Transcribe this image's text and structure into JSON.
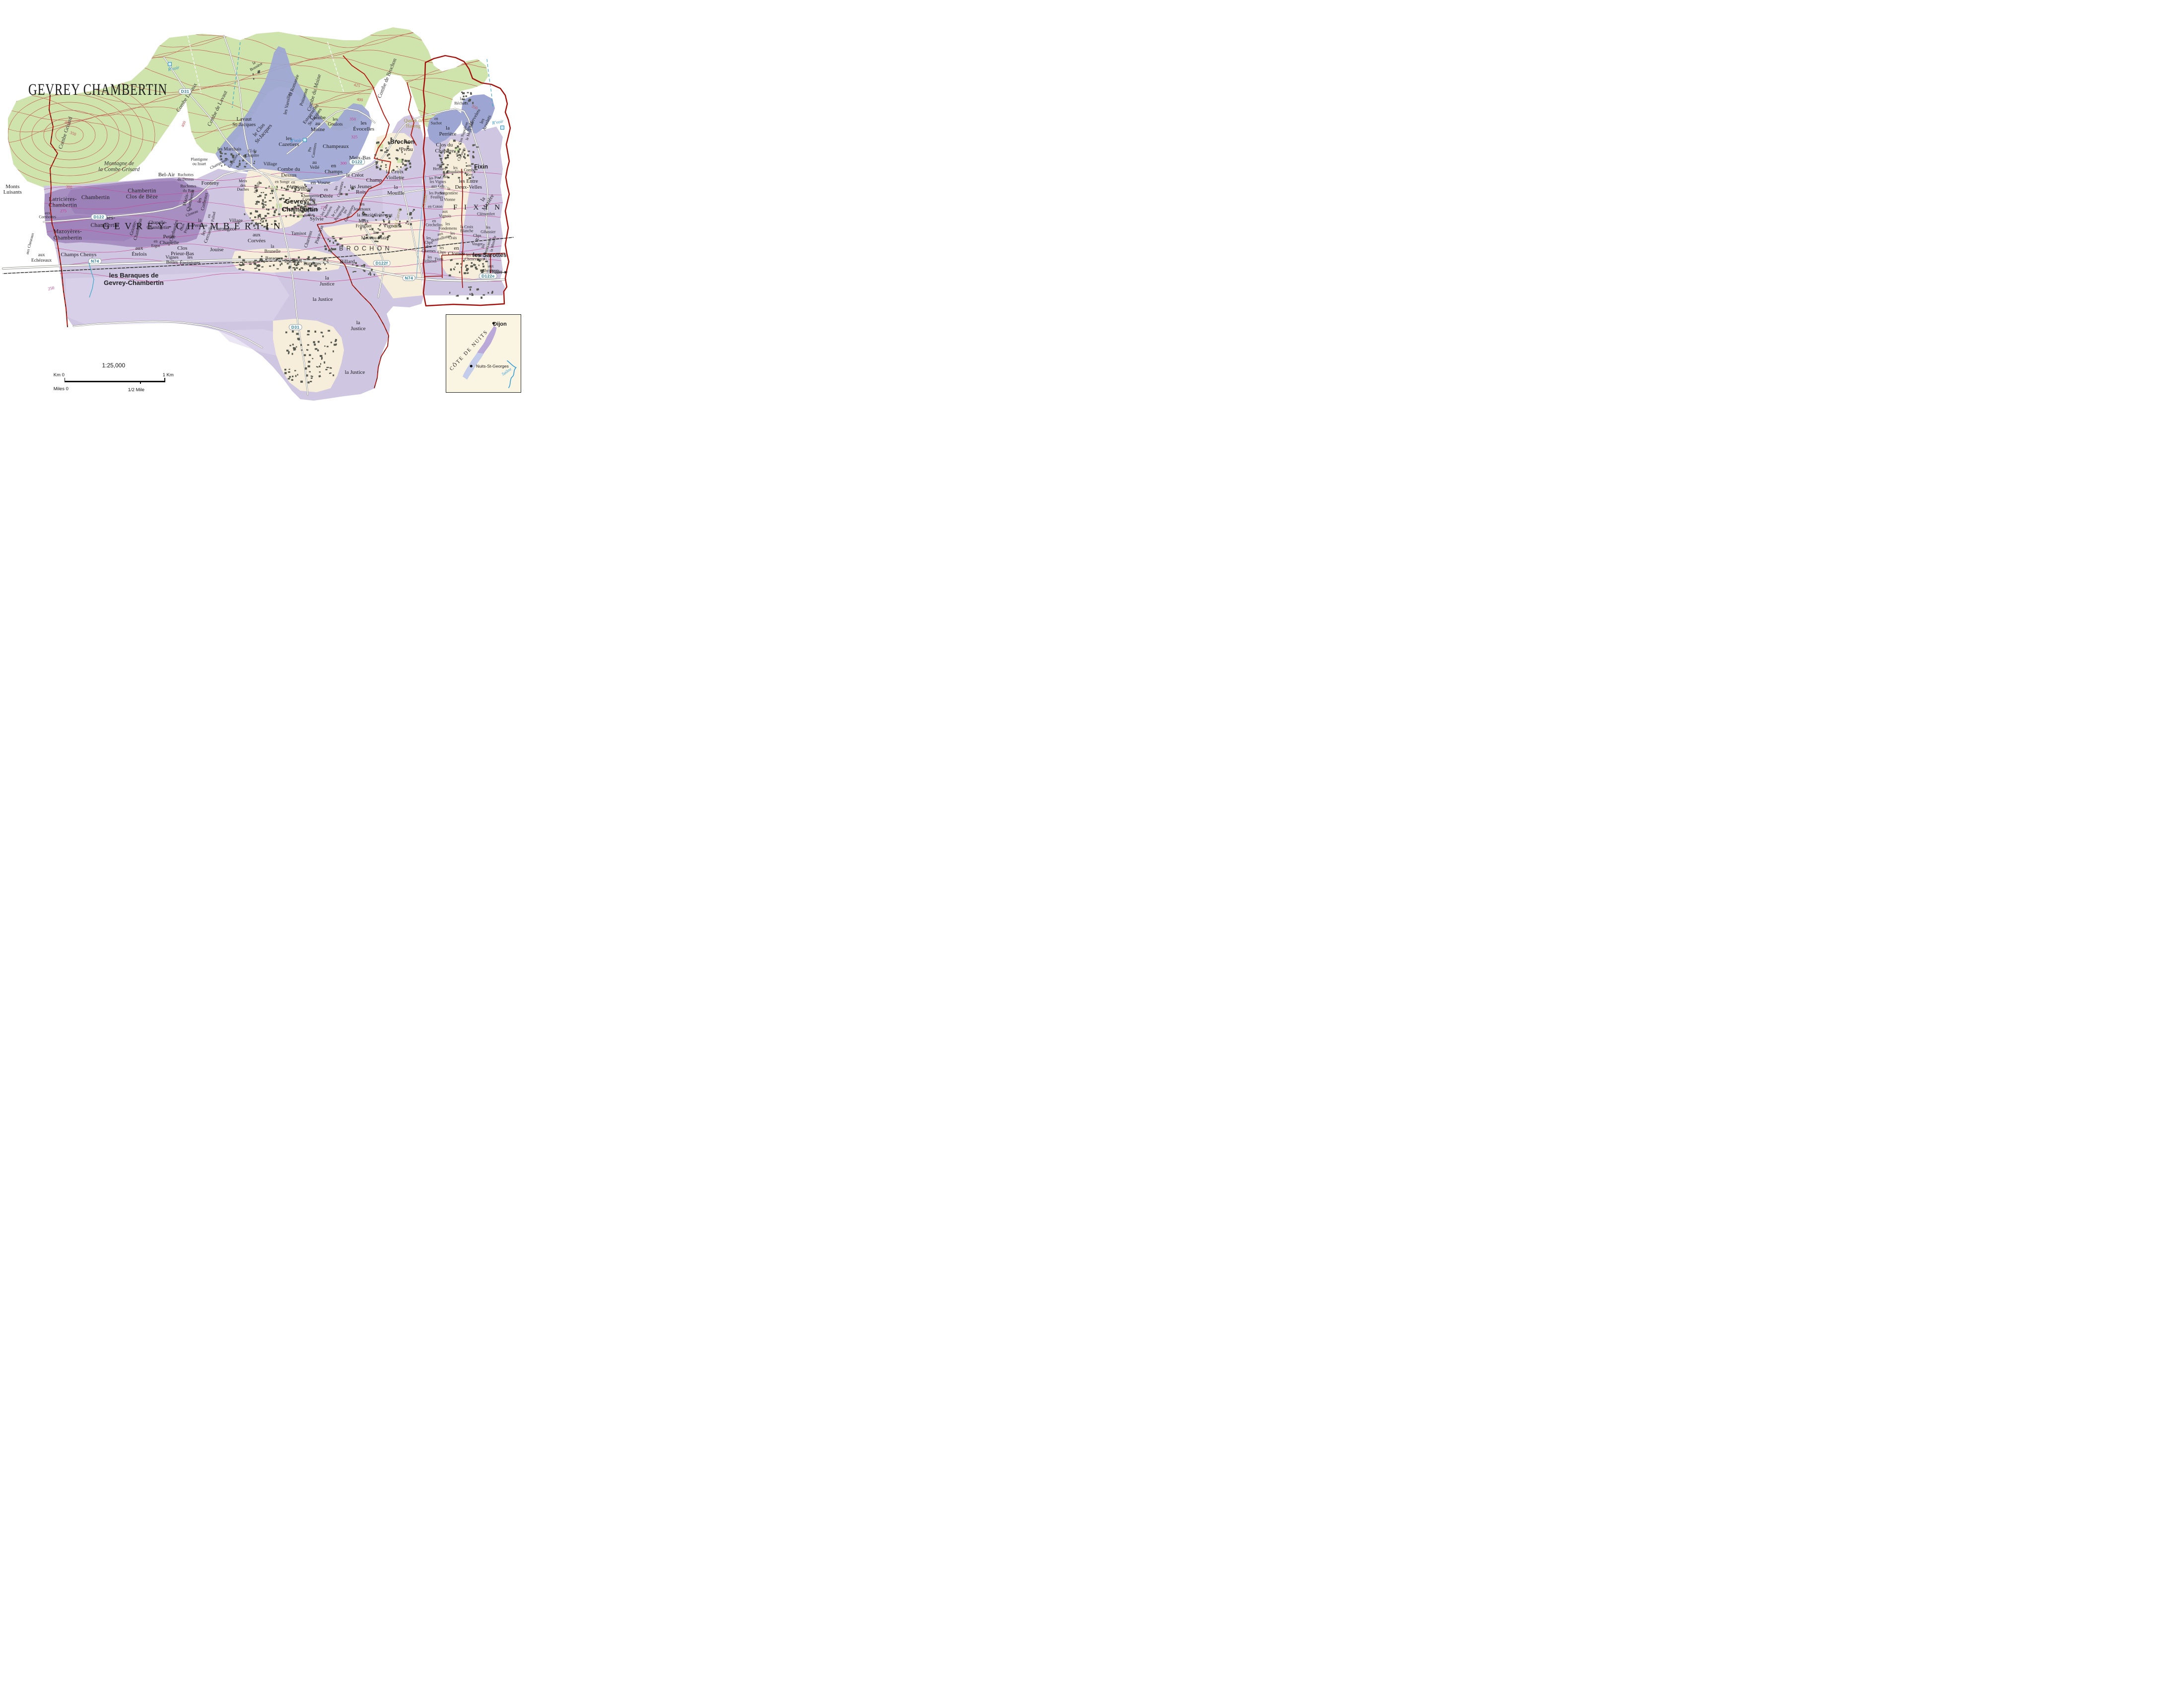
{
  "title": "GEVREY CHAMBERTIN",
  "scale_bar": {
    "ratio": "1:25,000",
    "km_zero": "Km 0",
    "km_one": "1 Km",
    "miles_zero": "Miles 0",
    "half_mile": "1/2 Mile"
  },
  "inset": {
    "region": "CÔTE DE NUITS",
    "city_north": "Dijon",
    "city_south": "Nuits-St-Georges",
    "river": "Saône"
  },
  "colors": {
    "boundary_red": "#b5170b",
    "grand_cru": "#9a7fb7",
    "premier_cru": "#9da5d3",
    "village_aoc": "#cfc6e2",
    "woodland": "#cfe3ad",
    "water_blue": "#2d93c9",
    "contour_woodland": "#c2564e",
    "contour_vineyard": "#c64a97",
    "road_badge_text": "#2e7f99",
    "building_grey": "#55594f",
    "town_cream": "#f6eeda"
  },
  "badges": [
    {
      "t": "D31",
      "x": 33.9,
      "y": 21.6
    },
    {
      "t": "D122",
      "x": 18.1,
      "y": 51.4
    },
    {
      "t": "D122",
      "x": 65.4,
      "y": 38.3
    },
    {
      "t": "N74",
      "x": 17.4,
      "y": 61.9
    },
    {
      "t": "N74",
      "x": 74.9,
      "y": 65.9
    },
    {
      "t": "D122f",
      "x": 69.9,
      "y": 62.4
    },
    {
      "t": "D122e",
      "x": 89.4,
      "y": 65.4
    },
    {
      "t": "D31",
      "x": 54.1,
      "y": 77.5
    }
  ],
  "labels": [
    {
      "t": "Combe Grisard",
      "x": 12.1,
      "y": 31.5,
      "c": "combe",
      "r": -72
    },
    {
      "t": "Montagne de\nla Combe Grisard",
      "x": 21.8,
      "y": 39.5,
      "c": "geoit"
    },
    {
      "t": "Combe Lavaux",
      "x": 34.3,
      "y": 23.2,
      "c": "combe",
      "r": -57
    },
    {
      "t": "Combe de Lavaut",
      "x": 39.9,
      "y": 25.8,
      "c": "combe",
      "r": -64
    },
    {
      "t": "la\nBossière",
      "x": 46.7,
      "y": 15.4,
      "c": "vys",
      "r": -30
    },
    {
      "t": "Combe du Moine",
      "x": 57.6,
      "y": 22.0,
      "c": "combe",
      "r": -74
    },
    {
      "t": "Combe de Brochon",
      "x": 71.0,
      "y": 18.6,
      "c": "combe",
      "r": -68
    },
    {
      "t": "Queue de\nHareng",
      "x": 75.7,
      "y": 29.4,
      "c": "olive"
    },
    {
      "t": "R'voir",
      "x": 31.8,
      "y": 16.3,
      "c": "water",
      "r": -12
    },
    {
      "t": "R'voir",
      "x": 54.2,
      "y": 33.4,
      "c": "water"
    },
    {
      "t": "R'voir",
      "x": 91.2,
      "y": 29.1,
      "c": "water",
      "r": -10
    },
    {
      "t": "",
      "x": 31.1,
      "y": 15.2,
      "c": "resv"
    },
    {
      "t": "",
      "x": 55.8,
      "y": 33.2,
      "c": "resv"
    },
    {
      "t": "",
      "x": 92.0,
      "y": 30.2,
      "c": "resv"
    },
    {
      "t": "Créole",
      "x": 77.9,
      "y": 47.6,
      "c": "oliveit",
      "r": -80
    },
    {
      "t": "les Carrés",
      "x": 72.9,
      "y": 51.6,
      "c": "oliveit",
      "r": -76
    },
    {
      "t": "400",
      "x": 12.4,
      "y": 29.2,
      "c": "cc",
      "r": 18
    },
    {
      "t": "350",
      "x": 13.4,
      "y": 31.6,
      "c": "cc",
      "r": 22
    },
    {
      "t": "300",
      "x": 12.6,
      "y": 44.4,
      "c": "cc",
      "r": 8
    },
    {
      "t": "400",
      "x": 33.6,
      "y": 29.4,
      "c": "cc",
      "r": -68
    },
    {
      "t": "425",
      "x": 65.4,
      "y": 20.2,
      "c": "cc",
      "r": 12
    },
    {
      "t": "400",
      "x": 65.9,
      "y": 23.6,
      "c": "cc",
      "r": 8
    },
    {
      "t": "350",
      "x": 86.9,
      "y": 25.4,
      "c": "cc",
      "r": 24
    },
    {
      "t": "350",
      "x": 64.6,
      "y": 28.2,
      "c": "cm"
    },
    {
      "t": "325",
      "x": 64.9,
      "y": 32.5,
      "c": "cm"
    },
    {
      "t": "300",
      "x": 62.9,
      "y": 38.7,
      "c": "cm"
    },
    {
      "t": "275",
      "x": 59.3,
      "y": 49.2,
      "c": "cm"
    },
    {
      "t": "275",
      "x": 11.6,
      "y": 50.0,
      "c": "cm"
    },
    {
      "t": "250",
      "x": 9.4,
      "y": 68.4,
      "c": "cm",
      "r": -14
    },
    {
      "t": "Lavaut\nSt-Jacques",
      "x": 44.7,
      "y": 29.0,
      "c": "vyl"
    },
    {
      "t": "le Clos\nSt-Jacques",
      "x": 47.9,
      "y": 31.3,
      "c": "vyl",
      "r": -50
    },
    {
      "t": "les Varoilles",
      "x": 52.7,
      "y": 24.5,
      "c": "vy",
      "r": -78
    },
    {
      "t": "la Romanée",
      "x": 53.9,
      "y": 20.2,
      "c": "vy",
      "r": -70
    },
    {
      "t": "Poissenot",
      "x": 55.7,
      "y": 23.0,
      "c": "vy",
      "r": -72
    },
    {
      "t": "Estournelles\nSt-Jacques",
      "x": 57.4,
      "y": 27.4,
      "c": "vy",
      "r": -54
    },
    {
      "t": "les\nCazetiers",
      "x": 52.9,
      "y": 33.7,
      "c": "vyl"
    },
    {
      "t": "Pts\nCazetiers",
      "x": 57.2,
      "y": 35.5,
      "c": "vys",
      "r": -80
    },
    {
      "t": "Combe\nau\nMoine",
      "x": 58.2,
      "y": 29.4,
      "c": "vyl"
    },
    {
      "t": "les\nGoulots",
      "x": 61.4,
      "y": 28.9,
      "c": "vy"
    },
    {
      "t": "les\nÉvocelles",
      "x": 66.6,
      "y": 30.0,
      "c": "vyl"
    },
    {
      "t": "Champeaux",
      "x": 61.5,
      "y": 34.8,
      "c": "vyl"
    },
    {
      "t": "Meix-Bas",
      "x": 65.9,
      "y": 37.5,
      "c": "vyl"
    },
    {
      "t": "en\nChamps",
      "x": 61.1,
      "y": 40.1,
      "c": "vyl"
    },
    {
      "t": "Champ",
      "x": 68.5,
      "y": 42.8,
      "c": "vyl"
    },
    {
      "t": "au\nVellé",
      "x": 57.6,
      "y": 39.2,
      "c": "vy"
    },
    {
      "t": "les Marchais",
      "x": 42.0,
      "y": 35.4,
      "c": "vy"
    },
    {
      "t": "Plantigone\nou Issart",
      "x": 36.5,
      "y": 38.4,
      "c": "vys"
    },
    {
      "t": "Champonnet",
      "x": 40.2,
      "y": 38.8,
      "c": "vys",
      "r": -28
    },
    {
      "t": "Craipillot",
      "x": 42.7,
      "y": 38.2,
      "c": "vys",
      "r": -58
    },
    {
      "t": "Cl du\nChapître",
      "x": 46.2,
      "y": 36.4,
      "c": "vys"
    },
    {
      "t": "Village",
      "x": 49.5,
      "y": 38.9,
      "c": "ham"
    },
    {
      "t": "Fonteny",
      "x": 38.5,
      "y": 43.5,
      "c": "vyl"
    },
    {
      "t": "Meix\ndes\nDuches",
      "x": 44.5,
      "y": 44.0,
      "c": "vys"
    },
    {
      "t": "Mévelle",
      "x": 47.2,
      "y": 44.4,
      "c": "vys",
      "r": -70
    },
    {
      "t": "en\nMotrot",
      "x": 53.7,
      "y": 43.8,
      "c": "vys"
    },
    {
      "t": "Combe du\nDessus",
      "x": 52.9,
      "y": 40.9,
      "c": "vyl"
    },
    {
      "t": "Gevrey-",
      "x": 54.4,
      "y": 47.8,
      "c": "town"
    },
    {
      "t": "Chambertin",
      "x": 54.9,
      "y": 49.6,
      "c": "town"
    },
    {
      "t": "Village",
      "x": 55.8,
      "y": 44.9,
      "c": "ham"
    },
    {
      "t": "Combes\ndu\nBas",
      "x": 56.6,
      "y": 48.4,
      "c": "vys"
    },
    {
      "t": "Village",
      "x": 43.2,
      "y": 52.4,
      "c": "ham"
    },
    {
      "t": "Ruchottes\ndu Dessus",
      "x": 34.0,
      "y": 42.0,
      "c": "vys"
    },
    {
      "t": "Ruchottes\ndu Bas",
      "x": 34.5,
      "y": 44.7,
      "c": "vys"
    },
    {
      "t": "Bel-Air",
      "x": 30.5,
      "y": 41.5,
      "c": "vyl"
    },
    {
      "t": "Mazis-\nChambertin",
      "x": 34.5,
      "y": 47.4,
      "c": "vy",
      "r": -77
    },
    {
      "t": "les\nCorbeaux",
      "x": 37.1,
      "y": 47.6,
      "c": "vy",
      "r": -77
    },
    {
      "t": "au\nCloseau",
      "x": 35.0,
      "y": 50.1,
      "c": "vys",
      "r": -22
    },
    {
      "t": "en\nPallud",
      "x": 38.7,
      "y": 51.3,
      "c": "vys",
      "r": -80
    },
    {
      "t": "les\nCercueils",
      "x": 37.8,
      "y": 55.4,
      "c": "vy",
      "r": -70
    },
    {
      "t": "la\nPerrière",
      "x": 36.6,
      "y": 52.9,
      "c": "vy"
    },
    {
      "t": "Carougeot",
      "x": 41.2,
      "y": 54.4,
      "c": "vyl"
    },
    {
      "t": "aux\nCorvées",
      "x": 47.0,
      "y": 56.5,
      "c": "vyl"
    },
    {
      "t": "Jouise",
      "x": 39.7,
      "y": 59.3,
      "c": "vyl"
    },
    {
      "t": "Tamisot",
      "x": 54.7,
      "y": 55.4,
      "c": "vy"
    },
    {
      "t": "la\nBrunelle",
      "x": 49.9,
      "y": 59.0,
      "c": "vy"
    },
    {
      "t": "Charreux",
      "x": 56.5,
      "y": 56.7,
      "c": "vy",
      "r": -72
    },
    {
      "t": "Pince-Vin",
      "x": 58.5,
      "y": 55.7,
      "c": "vy",
      "r": -72
    },
    {
      "t": "Sylvie",
      "x": 58.0,
      "y": 52.0,
      "c": "vyl"
    },
    {
      "t": "Chambertin",
      "x": 17.5,
      "y": 46.8,
      "c": "gc"
    },
    {
      "t": "Chambertin\nClos de Bèze",
      "x": 26.0,
      "y": 46.0,
      "c": "gc"
    },
    {
      "t": "Latricières-\nChambertin",
      "x": 11.5,
      "y": 48.0,
      "c": "gc"
    },
    {
      "t": "aux\nCombottes",
      "x": 8.7,
      "y": 51.0,
      "c": "vys"
    },
    {
      "t": "Charmes-",
      "x": 19.0,
      "y": 51.7,
      "c": "gc"
    },
    {
      "t": "Chambertin",
      "x": 19.2,
      "y": 53.4,
      "c": "gc"
    },
    {
      "t": "Mazoyères-\nChambertin",
      "x": 12.4,
      "y": 55.7,
      "c": "gc"
    },
    {
      "t": "Griotte-\nChambertin",
      "x": 24.9,
      "y": 54.2,
      "c": "vy",
      "r": -75
    },
    {
      "t": "Chapelle-\nChambertin",
      "x": 28.9,
      "y": 53.4,
      "c": "vy"
    },
    {
      "t": "Cherbaudes",
      "x": 31.9,
      "y": 54.7,
      "c": "vy",
      "r": -75
    },
    {
      "t": "Clos\nPrieur",
      "x": 33.8,
      "y": 54.0,
      "c": "vys",
      "r": -72
    },
    {
      "t": "Petite\nChapelle",
      "x": 31.0,
      "y": 56.9,
      "c": "vyl"
    },
    {
      "t": "en\nErgot",
      "x": 28.5,
      "y": 57.8,
      "c": "vys"
    },
    {
      "t": "aux\nÉtelois",
      "x": 25.5,
      "y": 59.7,
      "c": "vyl"
    },
    {
      "t": "Clos\nPrieur-Bas",
      "x": 33.4,
      "y": 59.6,
      "c": "vyl"
    },
    {
      "t": "Vignes\nBelles",
      "x": 31.5,
      "y": 61.6,
      "c": "vy"
    },
    {
      "t": "les\nÉpointures",
      "x": 34.8,
      "y": 61.7,
      "c": "vy"
    },
    {
      "t": "Champs Chenys",
      "x": 14.4,
      "y": 60.5,
      "c": "vyl"
    },
    {
      "t": "aux\nEchézeaux",
      "x": 7.6,
      "y": 61.1,
      "c": "vy"
    },
    {
      "t": "aux Cheseaux",
      "x": 5.5,
      "y": 57.8,
      "c": "vys",
      "r": -75
    },
    {
      "t": "Monts\nLuisants",
      "x": 2.3,
      "y": 45.0,
      "c": "vyl"
    },
    {
      "t": "GEVREY-CHAMBERTIN",
      "x": 35.5,
      "y": 53.8,
      "c": "sp",
      "s": 19,
      "ls": 0.5
    },
    {
      "t": "en Songe",
      "x": 51.7,
      "y": 43.2,
      "c": "vys"
    },
    {
      "t": "en Vosne",
      "x": 58.7,
      "y": 43.4,
      "c": "vyl"
    },
    {
      "t": "Chazière",
      "x": 54.8,
      "y": 44.5,
      "c": "vys"
    },
    {
      "t": "en",
      "x": 59.7,
      "y": 45.1,
      "c": "vys"
    },
    {
      "t": "Dérée",
      "x": 59.8,
      "y": 46.6,
      "c": "vyl"
    },
    {
      "t": "Champerrier\ndu\nDessus",
      "x": 57.0,
      "y": 47.5,
      "c": "vys"
    },
    {
      "t": "Champerrier\ndu Bas",
      "x": 56.5,
      "y": 50.5,
      "c": "vys",
      "r": -6
    },
    {
      "t": "les Clos\nPerriers",
      "x": 59.8,
      "y": 50.0,
      "c": "vys",
      "r": -63
    },
    {
      "t": "le Carré\nRougeaud",
      "x": 61.9,
      "y": 50.4,
      "c": "vys",
      "r": -55
    },
    {
      "t": "les\nGuelepines",
      "x": 63.6,
      "y": 50.4,
      "c": "vys",
      "r": -65
    },
    {
      "t": "les\nJournaux",
      "x": 66.3,
      "y": 49.0,
      "c": "vy"
    },
    {
      "t": "la Mazière",
      "x": 67.2,
      "y": 51.0,
      "c": "vy"
    },
    {
      "t": "Meix\nFringuet",
      "x": 66.6,
      "y": 53.0,
      "c": "vy"
    },
    {
      "t": "✝",
      "x": 66.1,
      "y": 54.3,
      "c": "sym"
    },
    {
      "t": "Crètevent",
      "x": 70.2,
      "y": 51.0,
      "c": "vy"
    },
    {
      "t": "Vignois",
      "x": 71.7,
      "y": 53.7,
      "c": "vyl"
    },
    {
      "t": "le\nMeix au Maire",
      "x": 68.7,
      "y": 55.8,
      "c": "vy"
    },
    {
      "t": "les\nCroisettes",
      "x": 62.0,
      "y": 44.7,
      "c": "vys",
      "r": -75
    },
    {
      "t": "les Jeunes\nRois",
      "x": 66.1,
      "y": 45.0,
      "c": "vyl"
    },
    {
      "t": "le Créot",
      "x": 65.0,
      "y": 41.7,
      "c": "vyl"
    },
    {
      "t": "la Croix\nViollette",
      "x": 72.3,
      "y": 41.5,
      "c": "vyl"
    },
    {
      "t": "la\nMouille",
      "x": 72.5,
      "y": 45.2,
      "c": "vyl"
    },
    {
      "t": "Préau",
      "x": 74.5,
      "y": 35.5,
      "c": "vyl"
    },
    {
      "t": "Brochon",
      "x": 73.7,
      "y": 33.7,
      "c": "town2"
    },
    {
      "t": "BROCHON",
      "x": 67.0,
      "y": 58.9,
      "c": "spx",
      "s": 12.5,
      "ls": 0.5
    },
    {
      "t": "Billard",
      "x": 63.6,
      "y": 62.1,
      "c": "vyl"
    },
    {
      "t": "la\nJustice",
      "x": 59.9,
      "y": 66.7,
      "c": "vyl"
    },
    {
      "t": "la Justice",
      "x": 59.1,
      "y": 71.1,
      "c": "vyl"
    },
    {
      "t": "la\nJustice",
      "x": 65.6,
      "y": 77.3,
      "c": "vyl"
    },
    {
      "t": "la Justice",
      "x": 65.0,
      "y": 88.4,
      "c": "vyl"
    },
    {
      "t": "les Baraques de",
      "x": 24.5,
      "y": 65.3,
      "c": "town"
    },
    {
      "t": "Gevrey-Chambertin",
      "x": 24.5,
      "y": 67.1,
      "c": "town"
    },
    {
      "t": "Baraques",
      "x": 50.2,
      "y": 61.3,
      "c": "ham"
    },
    {
      "t": "Baraques",
      "x": 53.7,
      "y": 62.0,
      "c": "ham"
    },
    {
      "t": "Baraques",
      "x": 57.2,
      "y": 62.6,
      "c": "ham"
    },
    {
      "t": "la\nRéchaux",
      "x": 84.5,
      "y": 24.0,
      "c": "vys"
    },
    {
      "t": "en\nSuchot",
      "x": 79.9,
      "y": 28.7,
      "c": "vys"
    },
    {
      "t": "la\nPerrière",
      "x": 82.0,
      "y": 31.2,
      "c": "vyl"
    },
    {
      "t": "Clos du\nChapître",
      "x": 81.4,
      "y": 35.2,
      "c": "vyl"
    },
    {
      "t": "Clos Napoléon",
      "x": 84.9,
      "y": 31.7,
      "c": "vys",
      "r": -72
    },
    {
      "t": "le Meix Bas",
      "x": 86.1,
      "y": 31.1,
      "c": "vys",
      "r": -72
    },
    {
      "t": "aux\nCheusots",
      "x": 84.2,
      "y": 36.4,
      "c": "vys",
      "r": -65
    },
    {
      "t": "les Hervelets",
      "x": 86.7,
      "y": 28.5,
      "c": "vy",
      "r": -60
    },
    {
      "t": "les\nArvelets",
      "x": 88.8,
      "y": 28.9,
      "c": "vy",
      "r": -68
    },
    {
      "t": "✝",
      "x": 82.0,
      "y": 37.0,
      "c": "sym"
    },
    {
      "t": "Fixin",
      "x": 88.1,
      "y": 39.5,
      "c": "town2"
    },
    {
      "t": "aux\nHerbues",
      "x": 80.5,
      "y": 39.6,
      "c": "vys"
    },
    {
      "t": "les\nBoudières",
      "x": 83.4,
      "y": 40.3,
      "c": "vys"
    },
    {
      "t": "en\nCombe\nRoy",
      "x": 86.0,
      "y": 40.4,
      "c": "vys"
    },
    {
      "t": "les Entre\nDeux-Velles",
      "x": 85.8,
      "y": 43.8,
      "c": "vyl"
    },
    {
      "t": "les Pts Crais",
      "x": 80.4,
      "y": 42.1,
      "c": "vys",
      "r": -6
    },
    {
      "t": "les Vignes\naux Gds",
      "x": 80.2,
      "y": 43.7,
      "c": "vys"
    },
    {
      "t": "les Portes\nFeuilles",
      "x": 80.0,
      "y": 46.3,
      "c": "vys"
    },
    {
      "t": "la\nSorgentière",
      "x": 82.2,
      "y": 45.3,
      "c": "vys"
    },
    {
      "t": "la Vionne",
      "x": 82.0,
      "y": 47.4,
      "c": "vys"
    },
    {
      "t": "en Coton",
      "x": 79.7,
      "y": 49.0,
      "c": "vys"
    },
    {
      "t": "aux\nVignois",
      "x": 81.5,
      "y": 50.7,
      "c": "vys"
    },
    {
      "t": "en\nCrechelins",
      "x": 79.5,
      "y": 52.9,
      "c": "vys"
    },
    {
      "t": "les\nFondemens",
      "x": 82.0,
      "y": 53.7,
      "c": "vys"
    },
    {
      "t": "les\nCrais",
      "x": 82.9,
      "y": 55.9,
      "c": "vys"
    },
    {
      "t": "aux\nBoutoillottes",
      "x": 80.7,
      "y": 56.0,
      "c": "vys",
      "r": -14
    },
    {
      "t": "les\nChps\ndes\nCharmes",
      "x": 78.5,
      "y": 58.0,
      "c": "vys"
    },
    {
      "t": "les\nChps",
      "x": 80.9,
      "y": 59.3,
      "c": "vys"
    },
    {
      "t": "Tions",
      "x": 80.4,
      "y": 61.5,
      "c": "vys"
    },
    {
      "t": "les\nTellières",
      "x": 78.7,
      "y": 61.5,
      "c": "vys"
    },
    {
      "t": "en\nClomée",
      "x": 83.6,
      "y": 59.6,
      "c": "vyl"
    },
    {
      "t": "la Croix\nBlanche",
      "x": 85.5,
      "y": 54.3,
      "c": "vys"
    },
    {
      "t": "Chps\nde\nVosger",
      "x": 87.4,
      "y": 56.9,
      "c": "vys"
    },
    {
      "t": "les\nGibassier",
      "x": 89.4,
      "y": 54.5,
      "c": "vys"
    },
    {
      "t": "les Basses\nChenevières",
      "x": 86.9,
      "y": 61.0,
      "c": "vys"
    },
    {
      "t": "les\nChenevières",
      "x": 88.9,
      "y": 58.5,
      "c": "vys",
      "r": -72
    },
    {
      "t": "la Mouille",
      "x": 90.4,
      "y": 57.8,
      "c": "vys",
      "r": -77
    },
    {
      "t": "la\nMazière",
      "x": 89.0,
      "y": 47.7,
      "c": "vyl",
      "r": -58
    },
    {
      "t": "Clémenfert",
      "x": 89.0,
      "y": 50.8,
      "c": "vys"
    },
    {
      "t": "FIXIN",
      "x": 87.9,
      "y": 49.2,
      "c": "sp",
      "s": 15,
      "ls": 0.9
    },
    {
      "t": "les Sarottes",
      "x": 89.7,
      "y": 60.5,
      "c": "town2"
    },
    {
      "t": "aux\nCheminots",
      "x": 89.9,
      "y": 63.7,
      "c": "vys"
    },
    {
      "t": "Dijon",
      "x": 90.8,
      "y": 64.5,
      "c": "dijon"
    }
  ],
  "building_clusters": [
    [
      52,
      47.2,
      11,
      8,
      95,
      3
    ],
    [
      47.6,
      51.6,
      6,
      5,
      35,
      5
    ],
    [
      43.6,
      37.6,
      7,
      3.6,
      26,
      7
    ],
    [
      71.8,
      36.4,
      6.6,
      8,
      56,
      11
    ],
    [
      68.8,
      53.6,
      5,
      7,
      42,
      13
    ],
    [
      83.8,
      37.6,
      7,
      9,
      62,
      17
    ],
    [
      84.6,
      22.8,
      4.2,
      3,
      12,
      19
    ],
    [
      52,
      62.2,
      17,
      3.4,
      78,
      23
    ],
    [
      85.6,
      63.2,
      7,
      4.2,
      38,
      29
    ],
    [
      56.6,
      84,
      10,
      13,
      78,
      31
    ],
    [
      66.6,
      63.6,
      5,
      3,
      18,
      37
    ],
    [
      86,
      69,
      9,
      3,
      16,
      41
    ],
    [
      60.6,
      57.6,
      4,
      4,
      20,
      43
    ],
    [
      74.2,
      51.4,
      3,
      4.2,
      14,
      47
    ],
    [
      47,
      17.6,
      2.4,
      2.4,
      5,
      53
    ],
    [
      63,
      45,
      2.6,
      2,
      5,
      59
    ]
  ]
}
